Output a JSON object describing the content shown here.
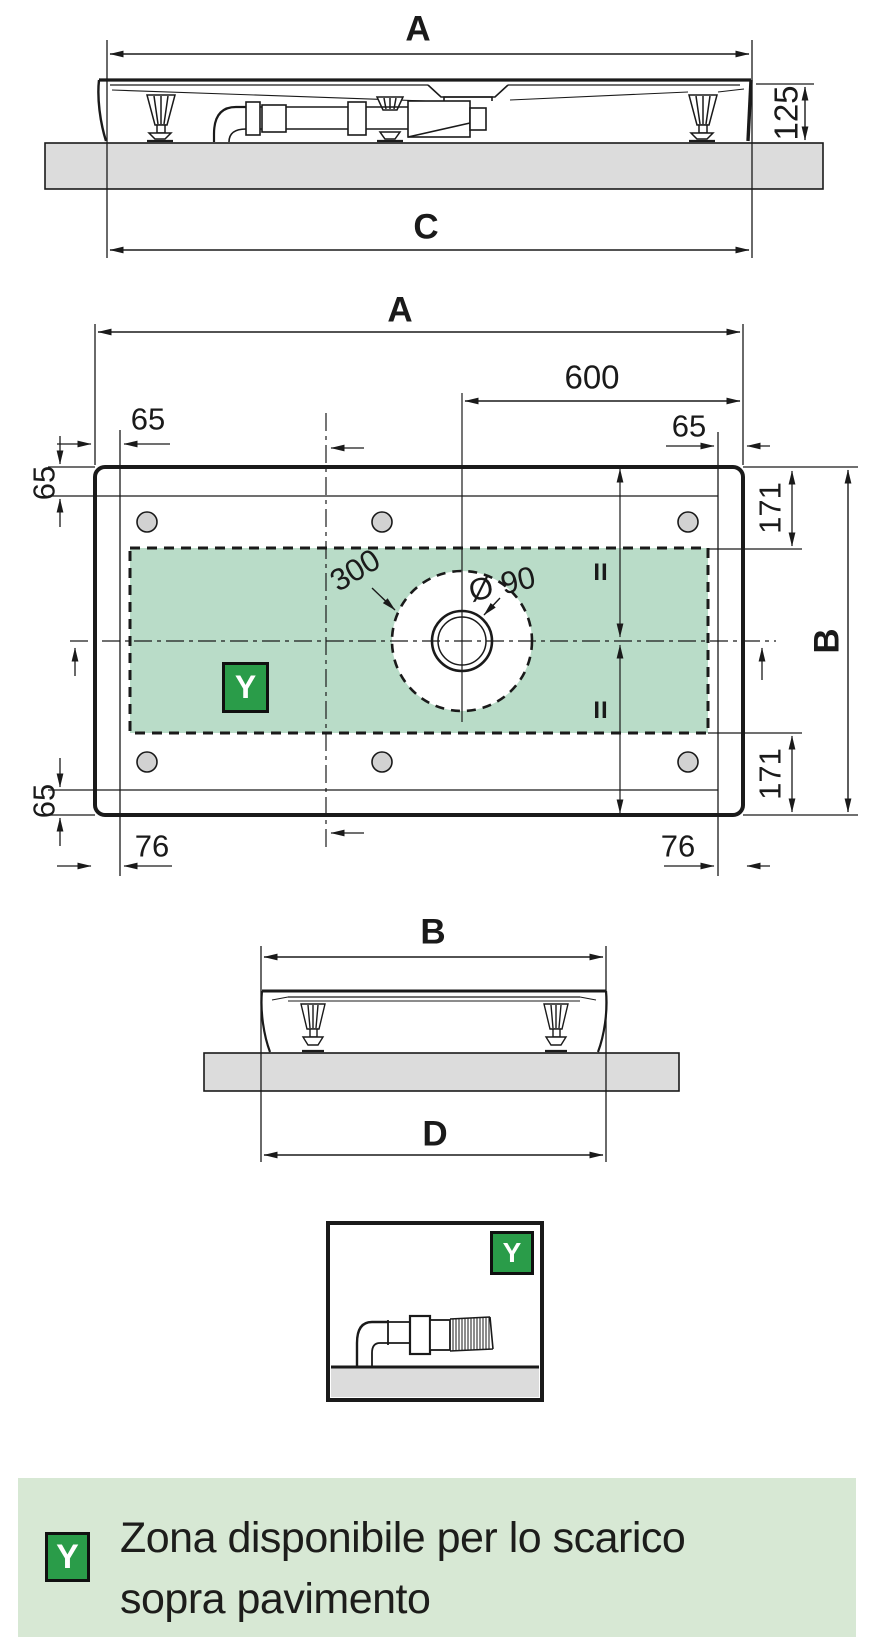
{
  "front_view": {
    "label_width_top": "A",
    "label_height": "125",
    "label_width_bottom": "C"
  },
  "plan_view": {
    "label_width_top": "A",
    "label_drain_offset": "600",
    "label_edge_top_left": "65",
    "label_edge_top_right": "65",
    "label_rim_left_top": "65",
    "label_rim_left_bottom": "65",
    "label_zone_inset_top": "171",
    "label_zone_inset_bottom": "171",
    "label_depth": "B",
    "label_edge_bottom_left": "76",
    "label_edge_bottom_right": "76",
    "label_zone_circle": "300",
    "label_drain_diameter": "Ø 90",
    "equal_mark_top": "II",
    "equal_mark_bottom": "II",
    "zone_badge": "Y"
  },
  "side_view": {
    "label_width_top": "B",
    "label_width_bottom": "D"
  },
  "detail_box": {
    "badge": "Y"
  },
  "legend": {
    "badge": "Y",
    "line1": "Zona disponibile per lo scarico",
    "line2": "sopra pavimento"
  },
  "colors": {
    "line": "#1a1a1a",
    "zone_green": "#b9dcc8",
    "badge_green": "#2a9c49",
    "legend_background": "#d7e8d4",
    "floor_gray": "#dcdcdc",
    "hole_gray": "#d2d2d2"
  }
}
